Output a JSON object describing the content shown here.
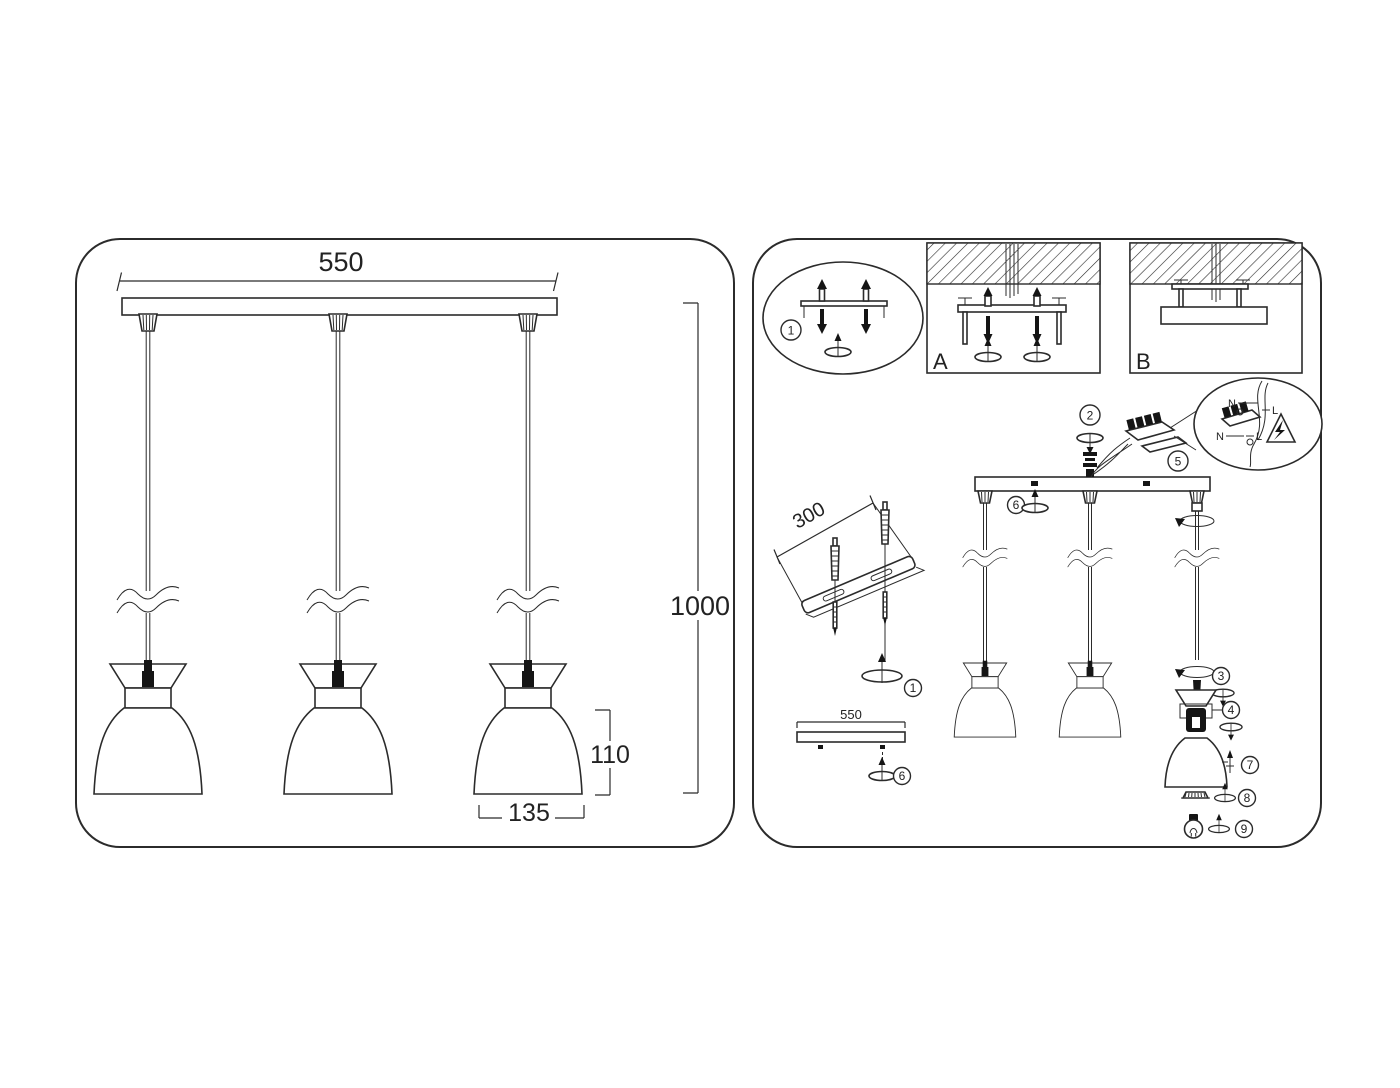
{
  "page": {
    "background": "#ffffff",
    "line_color": "#2b2b2b",
    "description_colors": {
      "fill": "#ffffff",
      "solid_parts": "#151515"
    }
  },
  "left_panel": {
    "dims": {
      "canopy_width": "550",
      "drop_height": "1000",
      "shade_height": "110",
      "shade_diameter": "135"
    }
  },
  "right_panel": {
    "callouts": {
      "c1": "1",
      "c2": "2",
      "c3": "3",
      "c4": "4",
      "c5": "5",
      "c6": "6",
      "c7": "7",
      "c8": "8",
      "c9": "9"
    },
    "options": {
      "a": "A",
      "b": "B"
    },
    "dims": {
      "bracket_length": "300",
      "canopy_width": "550"
    },
    "wiring": {
      "neutral": "N",
      "live": "L"
    }
  }
}
